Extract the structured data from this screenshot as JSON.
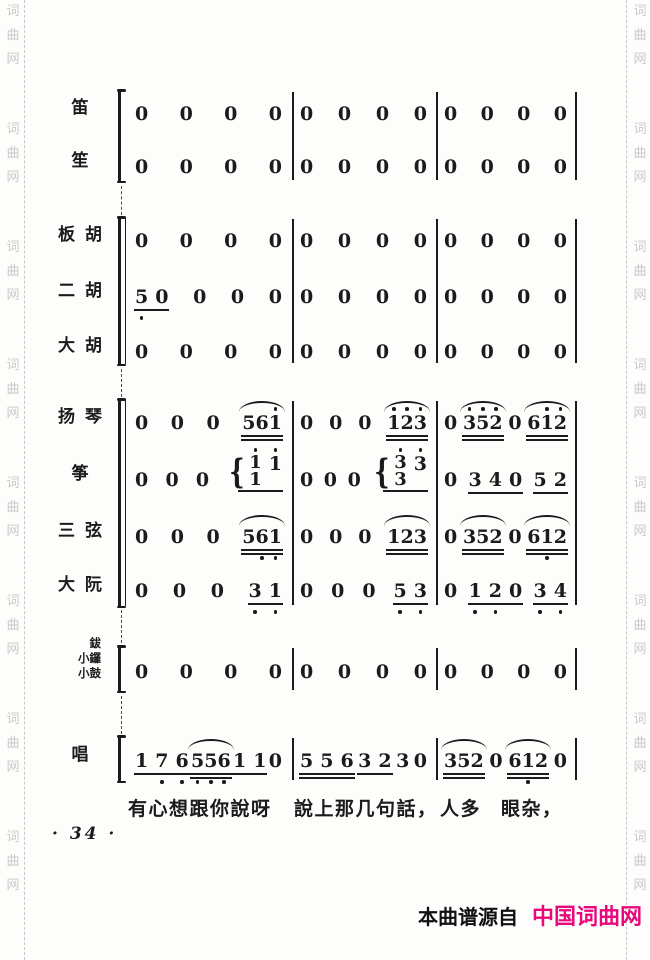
{
  "page": {
    "ink": "#1b1b1b",
    "background": "#fdfdfb",
    "accent_magenta": "#e8087c",
    "watermark_color": "#c9c9c9",
    "watermark_text": "词曲网",
    "page_number_display": "· 34 ·",
    "credit_prefix": "本曲谱源自",
    "credit_site": "中国词曲网"
  },
  "lyrics": {
    "top": 797,
    "segments": [
      {
        "t": "有心想跟你說呀",
        "x": 128
      },
      {
        "t": "說上那几句話，",
        "x": 294
      },
      {
        "t": "人多",
        "x": 440
      },
      {
        "t": "眼杂，",
        "x": 501
      }
    ]
  },
  "score": {
    "groups": [
      {
        "name": "winds",
        "top": 90,
        "height": 92,
        "bracket": "single",
        "rows": [
          {
            "label": "笛",
            "rel": 0,
            "measures": [
              "R",
              "R",
              "R"
            ]
          },
          {
            "label": "笙",
            "rel": 53,
            "measures": [
              "R",
              "R",
              "R"
            ]
          }
        ]
      },
      {
        "name": "bowed-strings",
        "top": 217,
        "height": 148,
        "bracket": "double",
        "rows": [
          {
            "label": "板胡",
            "rel": 0,
            "measures": [
              "R",
              "R",
              "R"
            ]
          },
          {
            "label": "二胡",
            "rel": 56,
            "measures": [
              [
                {
                  "t": "5 0",
                  "u": 1,
                  "db": [
                    1
                  ]
                },
                {
                  "t": "0"
                },
                {
                  "t": "0"
                },
                {
                  "t": "0"
                }
              ],
              "R",
              "R"
            ]
          },
          {
            "label": "大胡",
            "rel": 111,
            "measures": [
              "R",
              "R",
              "R"
            ]
          }
        ]
      },
      {
        "name": "plucked-strings",
        "top": 399,
        "height": 208,
        "bracket": "double",
        "rows": [
          {
            "label": "扬琴",
            "rel": 0,
            "measures": [
              [
                {
                  "t": "0"
                },
                {
                  "t": "0"
                },
                {
                  "t": "0"
                },
                {
                  "t": "561",
                  "u": 2,
                  "s": 1,
                  "da": [
                    3
                  ]
                }
              ],
              [
                {
                  "t": "0"
                },
                {
                  "t": "0"
                },
                {
                  "t": "0"
                },
                {
                  "t": "123",
                  "u": 2,
                  "s": 1,
                  "da": [
                    1,
                    2,
                    3
                  ]
                }
              ],
              [
                {
                  "t": "0"
                },
                {
                  "t": "352",
                  "u": 2,
                  "s": 1,
                  "da": [
                    1,
                    2,
                    3
                  ]
                },
                {
                  "t": "0"
                },
                {
                  "t": "612",
                  "u": 2,
                  "s": 1,
                  "da": [
                    2,
                    3
                  ]
                }
              ]
            ]
          },
          {
            "label": "筝",
            "rel": 57,
            "measures": [
              [
                {
                  "t": "0"
                },
                {
                  "t": "0"
                },
                {
                  "t": "0"
                },
                {
                  "chord": {
                    "top": "1",
                    "bottom": "1",
                    "after": "1"
                  },
                  "u": 1
                }
              ],
              [
                {
                  "t": "0"
                },
                {
                  "t": "0"
                },
                {
                  "t": "0"
                },
                {
                  "chord": {
                    "top": "3",
                    "bottom": "3",
                    "after": "3"
                  },
                  "u": 1
                }
              ],
              [
                {
                  "t": "0"
                },
                {
                  "t": "3 4 0",
                  "u": 1
                },
                {
                  "t": "5 2",
                  "u": 1
                }
              ]
            ]
          },
          {
            "label": "三弦",
            "rel": 114,
            "measures": [
              [
                {
                  "t": "0"
                },
                {
                  "t": "0"
                },
                {
                  "t": "0"
                },
                {
                  "t": "561",
                  "u": 2,
                  "s": 1,
                  "db": [
                    2,
                    3
                  ]
                }
              ],
              [
                {
                  "t": "0"
                },
                {
                  "t": "0"
                },
                {
                  "t": "0"
                },
                {
                  "t": "123",
                  "u": 2,
                  "s": 1
                }
              ],
              [
                {
                  "t": "0"
                },
                {
                  "t": "352",
                  "u": 2,
                  "s": 1
                },
                {
                  "t": "0"
                },
                {
                  "t": "612",
                  "u": 2,
                  "s": 1,
                  "db": [
                    2
                  ]
                }
              ]
            ]
          },
          {
            "label": "大阮",
            "rel": 168,
            "measures": [
              [
                {
                  "t": "0"
                },
                {
                  "t": "0"
                },
                {
                  "t": "0"
                },
                {
                  "t": "3 1",
                  "u": 1,
                  "db": [
                    1,
                    2
                  ]
                }
              ],
              [
                {
                  "t": "0"
                },
                {
                  "t": "0"
                },
                {
                  "t": "0"
                },
                {
                  "t": "5 3",
                  "u": 1,
                  "db": [
                    1,
                    2
                  ]
                }
              ],
              [
                {
                  "t": "0"
                },
                {
                  "t": "1 2 0",
                  "u": 1,
                  "db": [
                    1,
                    2
                  ]
                },
                {
                  "t": "3 4",
                  "u": 1,
                  "db": [
                    1,
                    2
                  ]
                }
              ]
            ]
          }
        ]
      },
      {
        "name": "percussion",
        "top": 646,
        "height": 46,
        "bracket": "single",
        "rows": [
          {
            "label": "鈸|小鑼|小鼓",
            "rel": 2,
            "measures": [
              "R",
              "R",
              "R"
            ]
          }
        ]
      },
      {
        "name": "vocal",
        "top": 736,
        "height": 46,
        "bracket": "single",
        "rows": [
          {
            "label": "唱",
            "rel": 1,
            "measures": [
              [
                {
                  "t": "1 7 6",
                  "u": 1,
                  "db": [
                    2,
                    3
                  ]
                },
                {
                  "t": "556",
                  "u": 2,
                  "s": 1,
                  "db": [
                    1,
                    2,
                    3
                  ]
                },
                {
                  "t": "1 1",
                  "u": 1
                },
                {
                  "t": "0"
                }
              ],
              [
                {
                  "t": "5 5 6",
                  "u": 2
                },
                {
                  "t": "3 2",
                  "u": 1
                },
                {
                  "t": "3"
                },
                {
                  "t": "0"
                }
              ],
              [
                {
                  "t": "352",
                  "u": 2,
                  "s": 1
                },
                {
                  "t": "0"
                },
                {
                  "t": "612",
                  "u": 2,
                  "s": 1,
                  "db": [
                    2
                  ]
                },
                {
                  "t": "0"
                }
              ]
            ]
          }
        ]
      }
    ],
    "connectors": [
      {
        "top": 186,
        "height": 29
      },
      {
        "top": 369,
        "height": 28
      },
      {
        "top": 610,
        "height": 33
      },
      {
        "top": 696,
        "height": 38
      }
    ]
  }
}
